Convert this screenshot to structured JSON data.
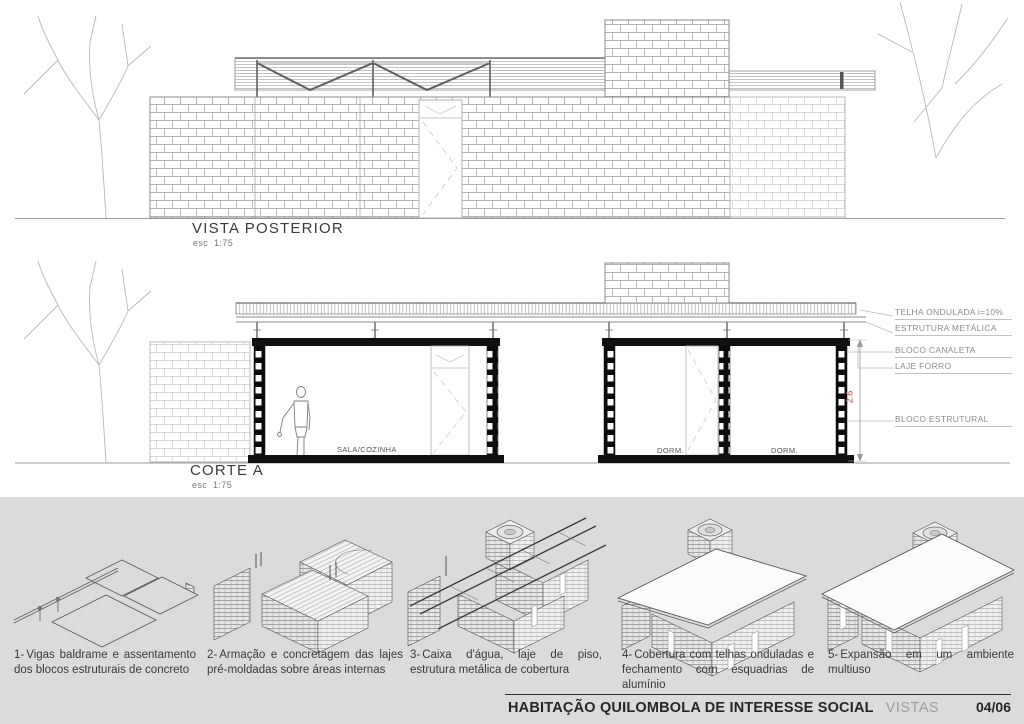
{
  "sheet": {
    "band_color": "#dbdbdb",
    "accent_red": "#b03a2e",
    "line_color": "#8c8c8c"
  },
  "vista_posterior": {
    "title": "VISTA POSTERIOR",
    "scale": "esc  1:75"
  },
  "corte_a": {
    "title": "CORTE A",
    "scale": "esc  1:75",
    "room_labels": [
      "SALA/COZINHA",
      "DORM.",
      "DORM."
    ],
    "annotations": [
      "TELHA ONDULADA i=10%",
      "ESTRUTURA METÁLICA",
      "BLOCO CANALETA",
      "LAJE FORRO",
      "BLOCO ESTRUTURAL"
    ],
    "dimension_height": "2.6"
  },
  "construction_steps": [
    {
      "num": "1-",
      "text": "Vigas baldrame e assentamento dos blocos estruturais de concreto"
    },
    {
      "num": "2-",
      "text": "Armação e concretagem das lajes pré-moldadas sobre áreas internas"
    },
    {
      "num": "3-",
      "text": "Caixa d'água, laje de piso, estrutura metálica de cobertura"
    },
    {
      "num": "4-",
      "text": "Cobertura com telhas onduladas e fechamento com esquadrias de alumínio"
    },
    {
      "num": "5-",
      "text": "Expansão em um ambiente multiuso"
    }
  ],
  "footer": {
    "project_title": "HABITAÇÃO QUILOMBOLA DE INTERESSE SOCIAL",
    "sheet_name": "VISTAS",
    "sheet_number": "04/06"
  }
}
